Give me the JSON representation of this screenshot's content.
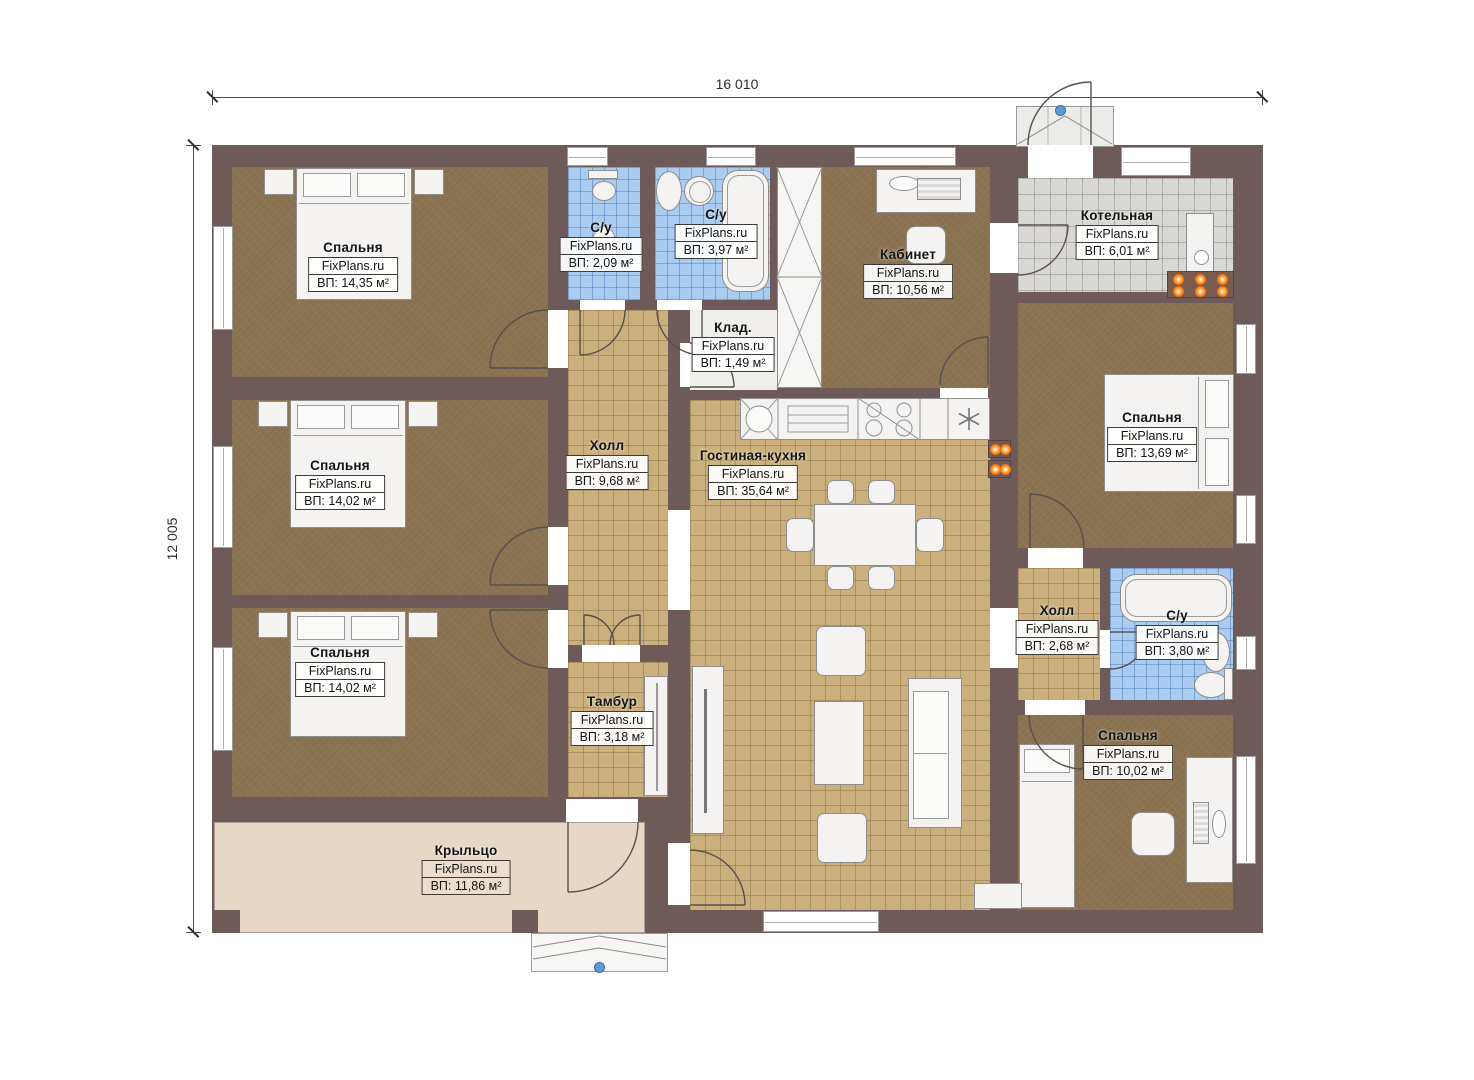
{
  "brand": "FixPlans.ru",
  "dimensions": {
    "top": "16 010",
    "left": "12 005"
  },
  "rooms": [
    {
      "name": "Спальня",
      "brand": "FixPlans.ru",
      "area": "ВП: 14,35 м²"
    },
    {
      "name": "С/у",
      "brand": "FixPlans.ru",
      "area": "ВП: 2,09 м²"
    },
    {
      "name": "С/у",
      "brand": "FixPlans.ru",
      "area": "ВП: 3,97 м²"
    },
    {
      "name": "Клад.",
      "brand": "FixPlans.ru",
      "area": "ВП: 1,49 м²"
    },
    {
      "name": "Кабинет",
      "brand": "FixPlans.ru",
      "area": "ВП: 10,56 м²"
    },
    {
      "name": "Котельная",
      "brand": "FixPlans.ru",
      "area": "ВП: 6,01 м²"
    },
    {
      "name": "Холл",
      "brand": "FixPlans.ru",
      "area": "ВП: 9,68 м²"
    },
    {
      "name": "Гостиная-кухня",
      "brand": "FixPlans.ru",
      "area": "ВП: 35,64 м²"
    },
    {
      "name": "Спальня",
      "brand": "FixPlans.ru",
      "area": "ВП: 13,69 м²"
    },
    {
      "name": "Спальня",
      "brand": "FixPlans.ru",
      "area": "ВП: 14,02 м²"
    },
    {
      "name": "Спальня",
      "brand": "FixPlans.ru",
      "area": "ВП: 14,02 м²"
    },
    {
      "name": "Тамбур",
      "brand": "FixPlans.ru",
      "area": "ВП: 3,18 м²"
    },
    {
      "name": "Холл",
      "brand": "FixPlans.ru",
      "area": "ВП: 2,68 м²"
    },
    {
      "name": "С/у",
      "brand": "FixPlans.ru",
      "area": "ВП: 3,80 м²"
    },
    {
      "name": "Спальня",
      "brand": "FixPlans.ru",
      "area": "ВП: 10,02 м²"
    },
    {
      "name": "Крыльцо",
      "brand": "FixPlans.ru",
      "area": "ВП: 11,86 м²"
    }
  ],
  "colors": {
    "wall": "#6e5b59",
    "bedroom_floor": "#8b7352",
    "hall_floor": "#cbb07e",
    "bath_floor": "#a9ccf0",
    "boiler_floor": "#d9d8d5",
    "porch_floor": "#e6d8c4",
    "burner_orange": "#ef5f00",
    "marker_blue": "#5b9bd5"
  }
}
